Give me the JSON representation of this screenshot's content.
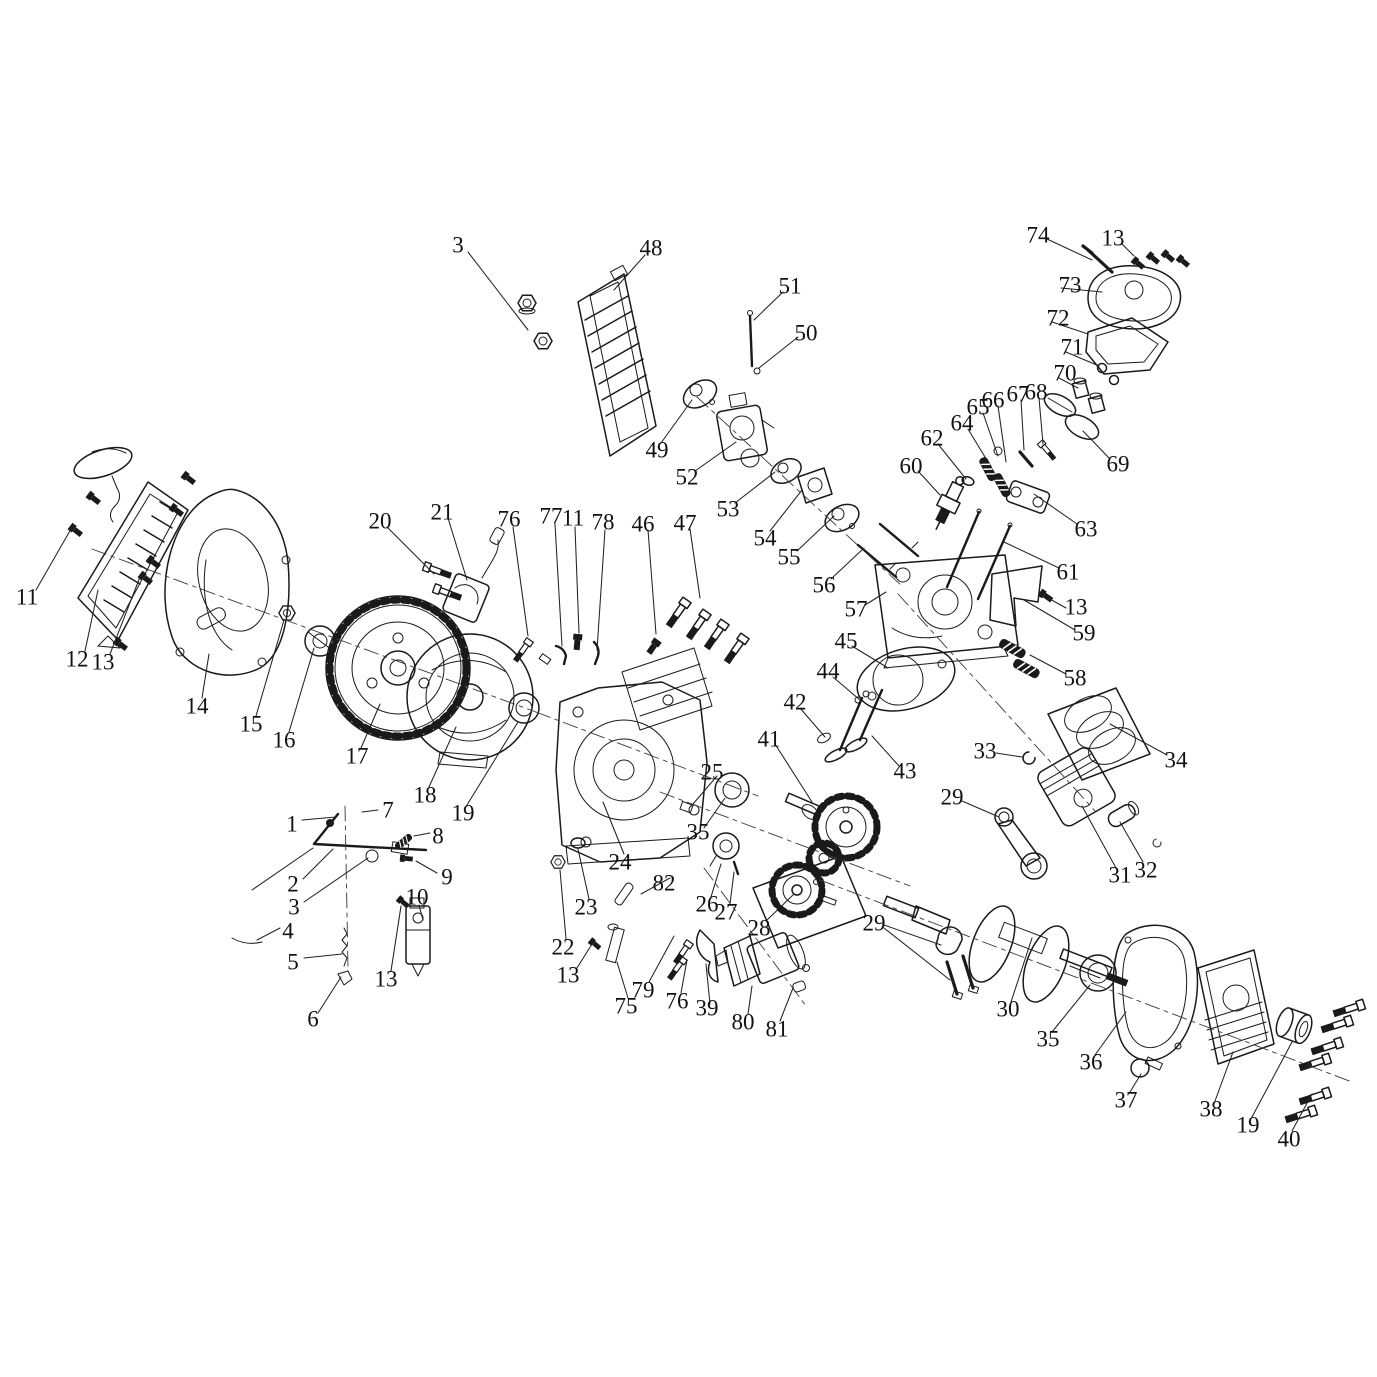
{
  "diagram": {
    "kind": "exploded-parts-diagram",
    "subject": "small-engine",
    "background": "#ffffff",
    "line_color": "#1a1a1a",
    "label_color": "#111111",
    "label_font_size": 23
  },
  "labels": [
    {
      "n": "1",
      "x": 292,
      "y": 824
    },
    {
      "n": "2",
      "x": 293,
      "y": 884
    },
    {
      "n": "3",
      "x": 294,
      "y": 907
    },
    {
      "n": "3",
      "x": 458,
      "y": 245
    },
    {
      "n": "4",
      "x": 288,
      "y": 931
    },
    {
      "n": "5",
      "x": 293,
      "y": 962
    },
    {
      "n": "6",
      "x": 313,
      "y": 1019
    },
    {
      "n": "7",
      "x": 388,
      "y": 810
    },
    {
      "n": "8",
      "x": 438,
      "y": 836
    },
    {
      "n": "9",
      "x": 447,
      "y": 877
    },
    {
      "n": "10",
      "x": 417,
      "y": 897
    },
    {
      "n": "11",
      "x": 27,
      "y": 597
    },
    {
      "n": "11",
      "x": 573,
      "y": 518
    },
    {
      "n": "12",
      "x": 77,
      "y": 659
    },
    {
      "n": "13",
      "x": 103,
      "y": 662
    },
    {
      "n": "13",
      "x": 386,
      "y": 979
    },
    {
      "n": "13",
      "x": 568,
      "y": 975
    },
    {
      "n": "13",
      "x": 1113,
      "y": 238
    },
    {
      "n": "13",
      "x": 1076,
      "y": 607
    },
    {
      "n": "14",
      "x": 197,
      "y": 706
    },
    {
      "n": "15",
      "x": 251,
      "y": 724
    },
    {
      "n": "16",
      "x": 284,
      "y": 740
    },
    {
      "n": "17",
      "x": 357,
      "y": 756
    },
    {
      "n": "18",
      "x": 425,
      "y": 795
    },
    {
      "n": "19",
      "x": 463,
      "y": 813
    },
    {
      "n": "19",
      "x": 1248,
      "y": 1125
    },
    {
      "n": "20",
      "x": 380,
      "y": 521
    },
    {
      "n": "21",
      "x": 442,
      "y": 512
    },
    {
      "n": "22",
      "x": 563,
      "y": 947
    },
    {
      "n": "23",
      "x": 586,
      "y": 907
    },
    {
      "n": "24",
      "x": 620,
      "y": 862
    },
    {
      "n": "25",
      "x": 712,
      "y": 772
    },
    {
      "n": "26",
      "x": 707,
      "y": 904
    },
    {
      "n": "27",
      "x": 726,
      "y": 912
    },
    {
      "n": "28",
      "x": 759,
      "y": 928
    },
    {
      "n": "29",
      "x": 952,
      "y": 797
    },
    {
      "n": "29",
      "x": 874,
      "y": 923
    },
    {
      "n": "30",
      "x": 1008,
      "y": 1009
    },
    {
      "n": "31",
      "x": 1120,
      "y": 875
    },
    {
      "n": "32",
      "x": 1146,
      "y": 870
    },
    {
      "n": "33",
      "x": 985,
      "y": 751
    },
    {
      "n": "34",
      "x": 1176,
      "y": 760
    },
    {
      "n": "35",
      "x": 698,
      "y": 832
    },
    {
      "n": "35",
      "x": 1048,
      "y": 1039
    },
    {
      "n": "36",
      "x": 1091,
      "y": 1062
    },
    {
      "n": "37",
      "x": 1126,
      "y": 1100
    },
    {
      "n": "38",
      "x": 1211,
      "y": 1109
    },
    {
      "n": "39",
      "x": 707,
      "y": 1008
    },
    {
      "n": "40",
      "x": 1289,
      "y": 1139
    },
    {
      "n": "41",
      "x": 769,
      "y": 739
    },
    {
      "n": "42",
      "x": 795,
      "y": 702
    },
    {
      "n": "43",
      "x": 905,
      "y": 771
    },
    {
      "n": "44",
      "x": 828,
      "y": 671
    },
    {
      "n": "45",
      "x": 846,
      "y": 641
    },
    {
      "n": "46",
      "x": 643,
      "y": 524
    },
    {
      "n": "47",
      "x": 685,
      "y": 523
    },
    {
      "n": "48",
      "x": 651,
      "y": 248
    },
    {
      "n": "49",
      "x": 657,
      "y": 450
    },
    {
      "n": "50",
      "x": 806,
      "y": 333
    },
    {
      "n": "51",
      "x": 790,
      "y": 286
    },
    {
      "n": "52",
      "x": 687,
      "y": 477
    },
    {
      "n": "53",
      "x": 728,
      "y": 509
    },
    {
      "n": "54",
      "x": 765,
      "y": 538
    },
    {
      "n": "55",
      "x": 789,
      "y": 557
    },
    {
      "n": "56",
      "x": 824,
      "y": 585
    },
    {
      "n": "57",
      "x": 856,
      "y": 609
    },
    {
      "n": "58",
      "x": 1075,
      "y": 678
    },
    {
      "n": "59",
      "x": 1084,
      "y": 633
    },
    {
      "n": "60",
      "x": 911,
      "y": 466
    },
    {
      "n": "61",
      "x": 1068,
      "y": 572
    },
    {
      "n": "62",
      "x": 932,
      "y": 438
    },
    {
      "n": "63",
      "x": 1086,
      "y": 529
    },
    {
      "n": "64",
      "x": 962,
      "y": 423
    },
    {
      "n": "65",
      "x": 978,
      "y": 407
    },
    {
      "n": "66",
      "x": 993,
      "y": 400
    },
    {
      "n": "67",
      "x": 1018,
      "y": 394
    },
    {
      "n": "68",
      "x": 1036,
      "y": 392
    },
    {
      "n": "69",
      "x": 1118,
      "y": 464
    },
    {
      "n": "70",
      "x": 1065,
      "y": 373
    },
    {
      "n": "71",
      "x": 1072,
      "y": 347
    },
    {
      "n": "72",
      "x": 1058,
      "y": 318
    },
    {
      "n": "73",
      "x": 1070,
      "y": 285
    },
    {
      "n": "74",
      "x": 1038,
      "y": 235
    },
    {
      "n": "75",
      "x": 626,
      "y": 1006
    },
    {
      "n": "76",
      "x": 509,
      "y": 519
    },
    {
      "n": "76",
      "x": 677,
      "y": 1001
    },
    {
      "n": "77",
      "x": 551,
      "y": 516
    },
    {
      "n": "78",
      "x": 603,
      "y": 522
    },
    {
      "n": "79",
      "x": 643,
      "y": 990
    },
    {
      "n": "80",
      "x": 743,
      "y": 1022
    },
    {
      "n": "81",
      "x": 777,
      "y": 1029
    },
    {
      "n": "82",
      "x": 664,
      "y": 883
    }
  ],
  "leader_lines": [
    [
      302,
      820,
      336,
      817
    ],
    [
      303,
      879,
      333,
      849
    ],
    [
      304,
      902,
      368,
      858
    ],
    [
      468,
      252,
      528,
      330
    ],
    [
      280,
      928,
      257,
      940
    ],
    [
      304,
      958,
      342,
      954
    ],
    [
      318,
      1013,
      341,
      977
    ],
    [
      378,
      810,
      362,
      812
    ],
    [
      430,
      833,
      414,
      836
    ],
    [
      437,
      873,
      416,
      861
    ],
    [
      419,
      905,
      423,
      920
    ],
    [
      36,
      590,
      71,
      529
    ],
    [
      575,
      527,
      579,
      633
    ],
    [
      85,
      651,
      98,
      590
    ],
    [
      110,
      654,
      140,
      577
    ],
    [
      391,
      971,
      401,
      906
    ],
    [
      577,
      968,
      592,
      944
    ],
    [
      1122,
      244,
      1134,
      256
    ],
    [
      1066,
      608,
      1048,
      598
    ],
    [
      202,
      698,
      209,
      654
    ],
    [
      256,
      716,
      284,
      620
    ],
    [
      289,
      732,
      314,
      648
    ],
    [
      361,
      748,
      380,
      704
    ],
    [
      429,
      787,
      456,
      727
    ],
    [
      467,
      805,
      518,
      722
    ],
    [
      1252,
      1117,
      1292,
      1042
    ],
    [
      387,
      527,
      434,
      574
    ],
    [
      448,
      518,
      467,
      580
    ],
    [
      566,
      939,
      560,
      870
    ],
    [
      589,
      899,
      578,
      849
    ],
    [
      624,
      854,
      603,
      802
    ],
    [
      717,
      776,
      693,
      804
    ],
    [
      711,
      897,
      721,
      864
    ],
    [
      730,
      904,
      734,
      872
    ],
    [
      766,
      921,
      794,
      894
    ],
    [
      962,
      801,
      999,
      817
    ],
    [
      884,
      925,
      941,
      945
    ],
    [
      884,
      928,
      950,
      980
    ],
    [
      1011,
      1002,
      1032,
      938
    ],
    [
      1116,
      868,
      1082,
      806
    ],
    [
      1143,
      862,
      1120,
      822
    ],
    [
      996,
      753,
      1022,
      757
    ],
    [
      1167,
      755,
      1110,
      724
    ],
    [
      704,
      828,
      725,
      798
    ],
    [
      1052,
      1032,
      1090,
      985
    ],
    [
      1095,
      1055,
      1126,
      1012
    ],
    [
      1130,
      1092,
      1141,
      1074
    ],
    [
      1215,
      1101,
      1233,
      1052
    ],
    [
      710,
      1004,
      706,
      964
    ],
    [
      1292,
      1131,
      1312,
      1094
    ],
    [
      775,
      744,
      812,
      802
    ],
    [
      800,
      708,
      825,
      737
    ],
    [
      899,
      766,
      872,
      736
    ],
    [
      833,
      677,
      860,
      700
    ],
    [
      852,
      646,
      888,
      668
    ],
    [
      648,
      530,
      656,
      634
    ],
    [
      690,
      529,
      700,
      598
    ],
    [
      645,
      255,
      614,
      290
    ],
    [
      661,
      443,
      692,
      400
    ],
    [
      798,
      337,
      759,
      368
    ],
    [
      783,
      292,
      754,
      320
    ],
    [
      695,
      471,
      736,
      442
    ],
    [
      735,
      503,
      775,
      472
    ],
    [
      770,
      531,
      802,
      490
    ],
    [
      797,
      551,
      834,
      516
    ],
    [
      831,
      579,
      864,
      548
    ],
    [
      865,
      605,
      886,
      592
    ],
    [
      1066,
      674,
      1030,
      655
    ],
    [
      1075,
      630,
      1024,
      600
    ],
    [
      918,
      471,
      940,
      495
    ],
    [
      1059,
      568,
      1004,
      542
    ],
    [
      938,
      444,
      966,
      479
    ],
    [
      1077,
      524,
      1034,
      494
    ],
    [
      968,
      429,
      988,
      462
    ],
    [
      983,
      413,
      998,
      456
    ],
    [
      998,
      406,
      1006,
      462
    ],
    [
      1021,
      400,
      1024,
      450
    ],
    [
      1039,
      398,
      1043,
      444
    ],
    [
      1110,
      459,
      1083,
      431
    ],
    [
      1059,
      378,
      1078,
      388
    ],
    [
      1066,
      352,
      1099,
      366
    ],
    [
      1052,
      322,
      1088,
      334
    ],
    [
      1061,
      288,
      1102,
      292
    ],
    [
      1047,
      239,
      1092,
      260
    ],
    [
      628,
      998,
      617,
      962
    ],
    [
      513,
      527,
      528,
      636
    ],
    [
      681,
      993,
      687,
      960
    ],
    [
      555,
      524,
      562,
      646
    ],
    [
      605,
      530,
      597,
      650
    ],
    [
      649,
      982,
      674,
      936
    ],
    [
      748,
      1014,
      752,
      986
    ],
    [
      780,
      1021,
      793,
      988
    ],
    [
      670,
      878,
      641,
      894
    ]
  ],
  "centerlines": [
    [
      92,
      549,
      536,
      712
    ],
    [
      536,
      712,
      758,
      796
    ],
    [
      820,
      880,
      1352,
      1082
    ],
    [
      660,
      792,
      910,
      886
    ],
    [
      898,
      594,
      1096,
      812
    ],
    [
      704,
      868,
      806,
      1006
    ],
    [
      697,
      397,
      902,
      586
    ],
    [
      345,
      806,
      348,
      968
    ]
  ]
}
